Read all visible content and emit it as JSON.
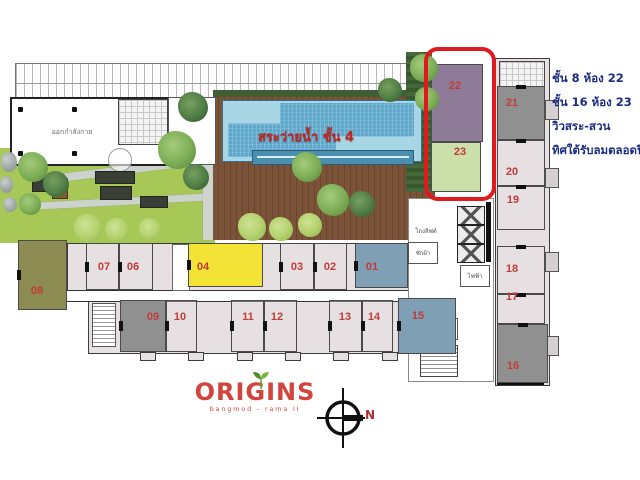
{
  "annotation": {
    "lines": [
      "ชั้น 8 ห้อง 22",
      "ชั้น 16 ห้อง 23",
      "วิวสระ-สวน",
      "ทิศใต้รับลมตลอดปี"
    ],
    "color": "#1b2b80"
  },
  "pool": {
    "label": "สระว่ายน้ำ ชั้น 4"
  },
  "logo": {
    "name": "ORIGINS",
    "subtitle": "bangmod - rama II"
  },
  "compass": {
    "label": "N"
  },
  "room_labels": {
    "fitness": "ออกกำลังกาย",
    "elevator_hall": "โถงลิฟต์",
    "laundry": "ซักผ้า",
    "electric": "ไฟฟ้า",
    "garbage": "พักขยะ"
  },
  "highlight": {
    "units": [
      "22",
      "23"
    ],
    "outline_color": "#e1191f"
  },
  "colors": {
    "unit_plain": "#e7e0e2",
    "unit_olive": "#8c8c52",
    "unit_yellow": "#f2e336",
    "unit_blue": "#7f9fb4",
    "unit_gray": "#909090",
    "unit_purple": "#8e7b97",
    "unit_green": "#cadfa9",
    "number_red": "#c23b38",
    "pool_blue": "#5fa7cb",
    "lawn_green": "#a7c757",
    "deck_brown": "#7b5338",
    "annotation_navy": "#1b2b80",
    "logo_red": "#d2453e"
  },
  "plan": {
    "units": [
      {
        "n": "08",
        "r": [
          18,
          240,
          49,
          70
        ],
        "l": [
          37,
          285
        ],
        "f": "#8c8c52",
        "o": "h"
      },
      {
        "n": "07",
        "r": [
          86,
          243,
          33,
          47
        ],
        "l": [
          104,
          261
        ],
        "f": null,
        "o": "h"
      },
      {
        "n": "06",
        "r": [
          119,
          243,
          34,
          47
        ],
        "l": [
          133,
          261
        ],
        "f": null,
        "o": "h"
      },
      {
        "n": "04",
        "r": [
          188,
          243,
          75,
          44
        ],
        "l": [
          203,
          261
        ],
        "f": "#f2e336",
        "o": "h"
      },
      {
        "n": "03",
        "r": [
          280,
          243,
          34,
          47
        ],
        "l": [
          297,
          261
        ],
        "f": null,
        "o": "h"
      },
      {
        "n": "02",
        "r": [
          314,
          243,
          33,
          47
        ],
        "l": [
          330,
          261
        ],
        "f": null,
        "o": "h"
      },
      {
        "n": "01",
        "r": [
          355,
          243,
          53,
          45
        ],
        "l": [
          372,
          261
        ],
        "f": "#7f9fb4",
        "o": "h"
      },
      {
        "n": "09",
        "r": [
          120,
          300,
          46,
          52
        ],
        "l": [
          153,
          311
        ],
        "f": "#909090",
        "o": "h"
      },
      {
        "n": "10",
        "r": [
          166,
          300,
          31,
          52
        ],
        "l": [
          180,
          311
        ],
        "f": null,
        "o": "h"
      },
      {
        "n": "11",
        "r": [
          231,
          300,
          33,
          52
        ],
        "l": [
          248,
          311
        ],
        "f": null,
        "o": "h"
      },
      {
        "n": "12",
        "r": [
          264,
          300,
          33,
          52
        ],
        "l": [
          277,
          311
        ],
        "f": null,
        "o": "h"
      },
      {
        "n": "13",
        "r": [
          329,
          300,
          33,
          52
        ],
        "l": [
          345,
          311
        ],
        "f": null,
        "o": "h"
      },
      {
        "n": "14",
        "r": [
          362,
          300,
          31,
          52
        ],
        "l": [
          374,
          311
        ],
        "f": null,
        "o": "h"
      },
      {
        "n": "15",
        "r": [
          398,
          298,
          58,
          56
        ],
        "l": [
          418,
          310
        ],
        "f": "#7f9fb4",
        "o": "h"
      },
      {
        "n": "21",
        "r": [
          497,
          86,
          48,
          54
        ],
        "l": [
          512,
          97
        ],
        "f": "#909090",
        "o": "v"
      },
      {
        "n": "20",
        "r": [
          497,
          140,
          48,
          46
        ],
        "l": [
          512,
          166
        ],
        "f": null,
        "o": "v"
      },
      {
        "n": "19",
        "r": [
          497,
          186,
          48,
          44
        ],
        "l": [
          513,
          194
        ],
        "f": null,
        "o": "v"
      },
      {
        "n": "18",
        "r": [
          497,
          246,
          48,
          48
        ],
        "l": [
          512,
          263
        ],
        "f": null,
        "o": "v"
      },
      {
        "n": "17",
        "r": [
          497,
          294,
          48,
          30
        ],
        "l": [
          512,
          291
        ],
        "f": null,
        "o": "v"
      },
      {
        "n": "16",
        "r": [
          497,
          324,
          51,
          59
        ],
        "l": [
          513,
          360
        ],
        "f": "#909090",
        "o": "v"
      },
      {
        "n": "22",
        "r": [
          431,
          64,
          52,
          78
        ],
        "l": [
          455,
          80
        ],
        "f": "#8e7b97",
        "o": ""
      },
      {
        "n": "23",
        "r": [
          431,
          142,
          50,
          50
        ],
        "l": [
          460,
          146
        ],
        "f": "#cadfa9",
        "o": ""
      }
    ],
    "trees": [
      [
        193,
        107,
        15,
        "dark"
      ],
      [
        177,
        150,
        19,
        "mid"
      ],
      [
        196,
        177,
        13,
        "dark"
      ],
      [
        307,
        167,
        15,
        "mid"
      ],
      [
        333,
        200,
        16,
        "mid"
      ],
      [
        362,
        204,
        13,
        "dark"
      ],
      [
        390,
        90,
        12,
        "dark"
      ],
      [
        424,
        68,
        14,
        "mid"
      ],
      [
        427,
        99,
        12,
        "mid"
      ],
      [
        33,
        167,
        15,
        "mid"
      ],
      [
        56,
        184,
        13,
        "dark"
      ],
      [
        30,
        204,
        11,
        "mid"
      ],
      [
        88,
        228,
        14,
        "light"
      ],
      [
        117,
        230,
        12,
        "light"
      ],
      [
        150,
        229,
        11,
        "light"
      ],
      [
        252,
        227,
        14,
        "light"
      ],
      [
        281,
        229,
        12,
        "light"
      ],
      [
        310,
        225,
        12,
        "light"
      ]
    ],
    "planters": [
      [
        32,
        178,
        28,
        12
      ],
      [
        95,
        171,
        38,
        11
      ],
      [
        100,
        186,
        30,
        12
      ],
      [
        140,
        196,
        26,
        10
      ]
    ],
    "balconies_x": [
      140,
      188,
      237,
      285,
      333,
      382
    ],
    "rocks": [
      [
        1,
        152,
        16,
        20
      ],
      [
        0,
        176,
        13,
        17
      ],
      [
        3,
        197,
        14,
        15
      ]
    ]
  }
}
